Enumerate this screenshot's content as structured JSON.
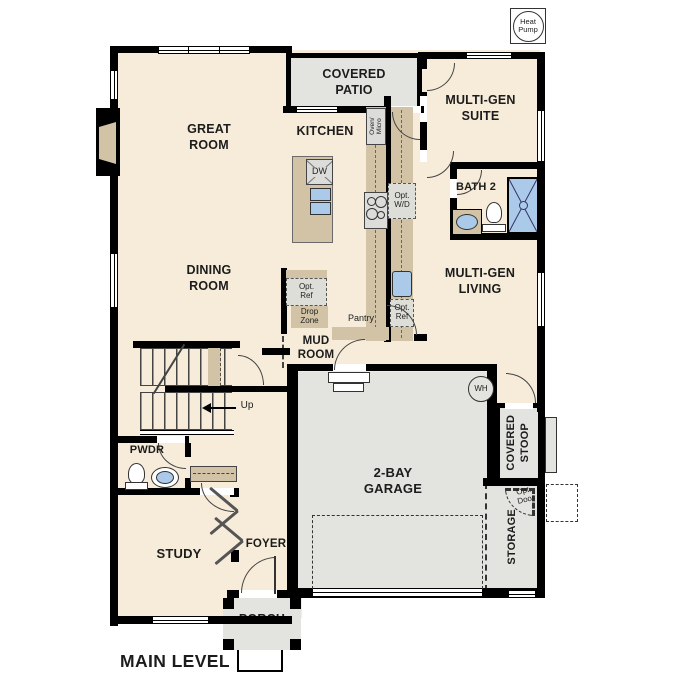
{
  "plan": {
    "title": "MAIN LEVEL",
    "heat_pump_label": "Heat Pump"
  },
  "rooms": {
    "great_room": "GREAT ROOM",
    "kitchen": "KITCHEN",
    "covered_patio": "COVERED PATIO",
    "multi_gen_suite": "MULTI-GEN SUITE",
    "bath_2": "BATH 2",
    "multi_gen_living": "MULTI-GEN LIVING",
    "dining_room": "DINING ROOM",
    "mud_room": "MUD ROOM",
    "pantry": "Pantry",
    "drop_zone": "Drop Zone",
    "pwdr": "PWDR",
    "study": "STUDY",
    "foyer": "FOYER",
    "porch": "PORCH",
    "garage": "2-BAY GARAGE",
    "covered_stoop": "COVERED STOOP",
    "storage": "STORAGE"
  },
  "fixtures": {
    "dishwasher": "DW",
    "oven_micro": "Oven/ Micro",
    "opt_washer_dryer": "Opt. W/D",
    "opt_ref": "Opt. Ref",
    "water_heater": "WH",
    "opt_door": "Opt. Door",
    "stairs_up": "Up"
  },
  "colors": {
    "room_fill": "#f6ecd9",
    "outdoor_fill": "#e3e3e0",
    "counter_fill": "#d2c3a6",
    "fixture_blue": "#abc9e9",
    "wall": "#000000"
  }
}
